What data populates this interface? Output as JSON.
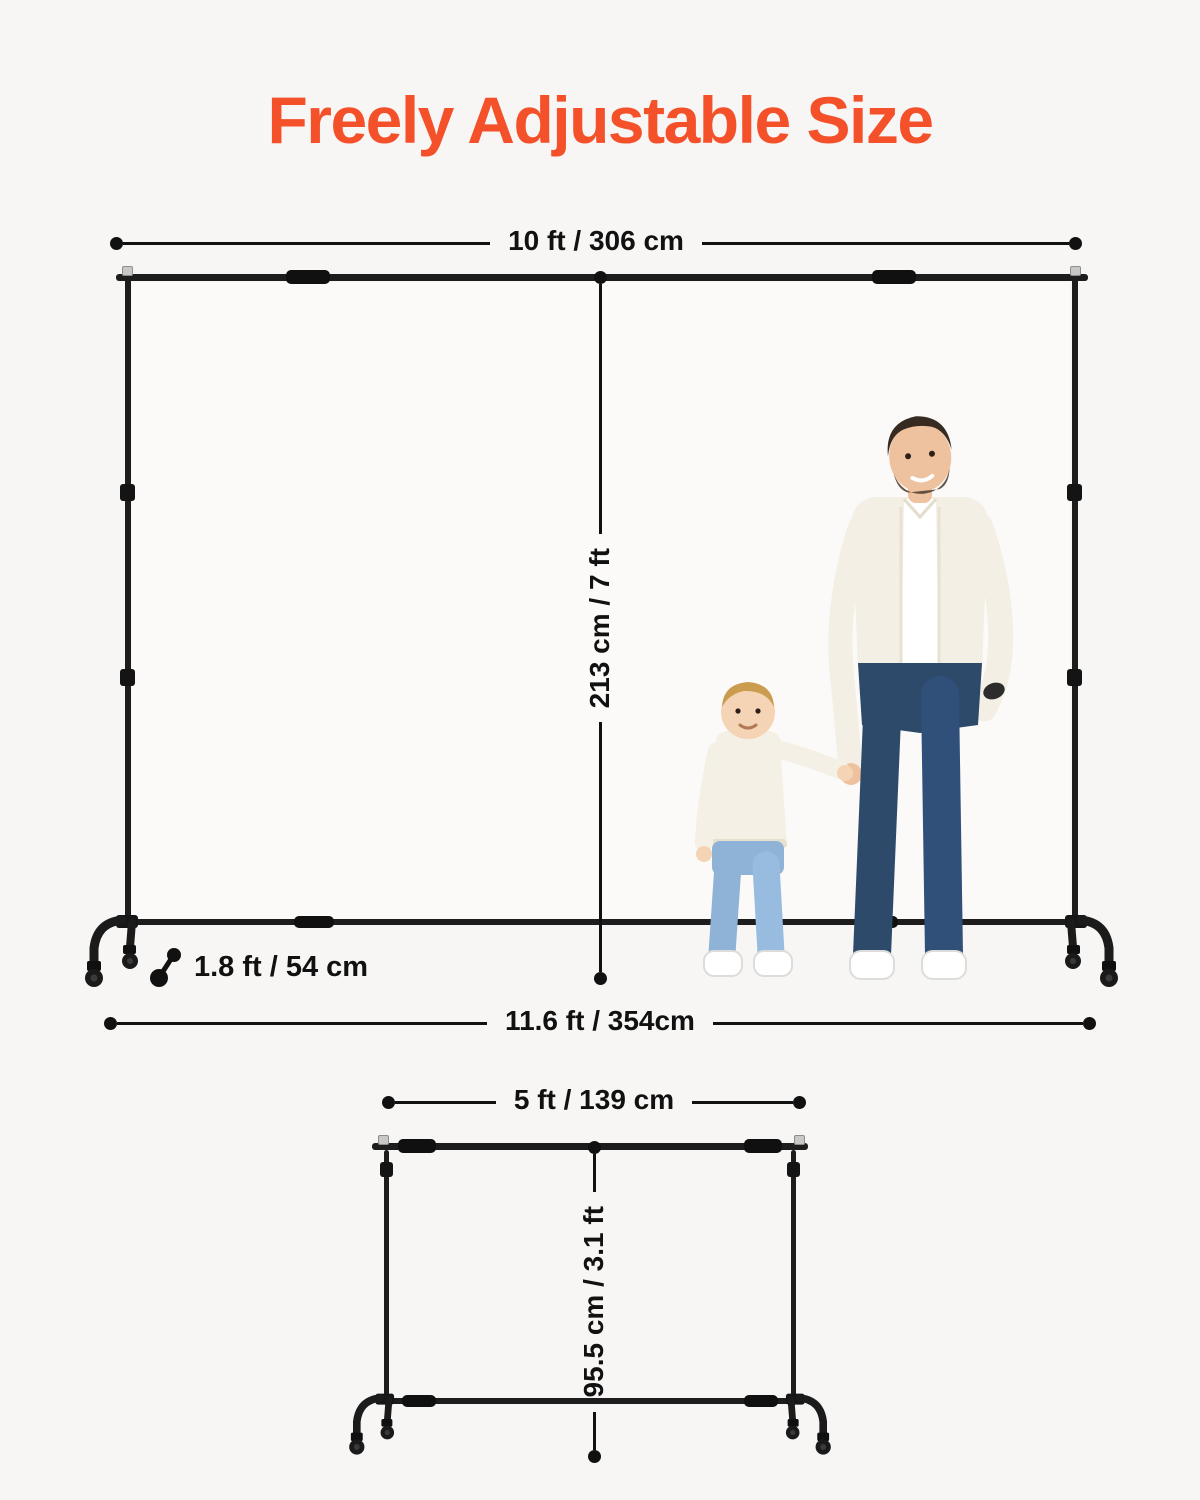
{
  "title": {
    "text": "Freely Adjustable Size"
  },
  "colors": {
    "accent": "#f4502a",
    "ink": "#111111",
    "frame": "#1d1d1d",
    "background": "#f7f6f4"
  },
  "large_stand": {
    "top_width_label": "10 ft / 306 cm",
    "height_label": "213 cm / 7 ft",
    "base_width_label": "11.6 ft / 354cm",
    "base_depth_label": "1.8 ft / 54 cm"
  },
  "small_stand": {
    "top_width_label": "5 ft / 139 cm",
    "height_label": "95.5 cm / 3.1 ft"
  }
}
